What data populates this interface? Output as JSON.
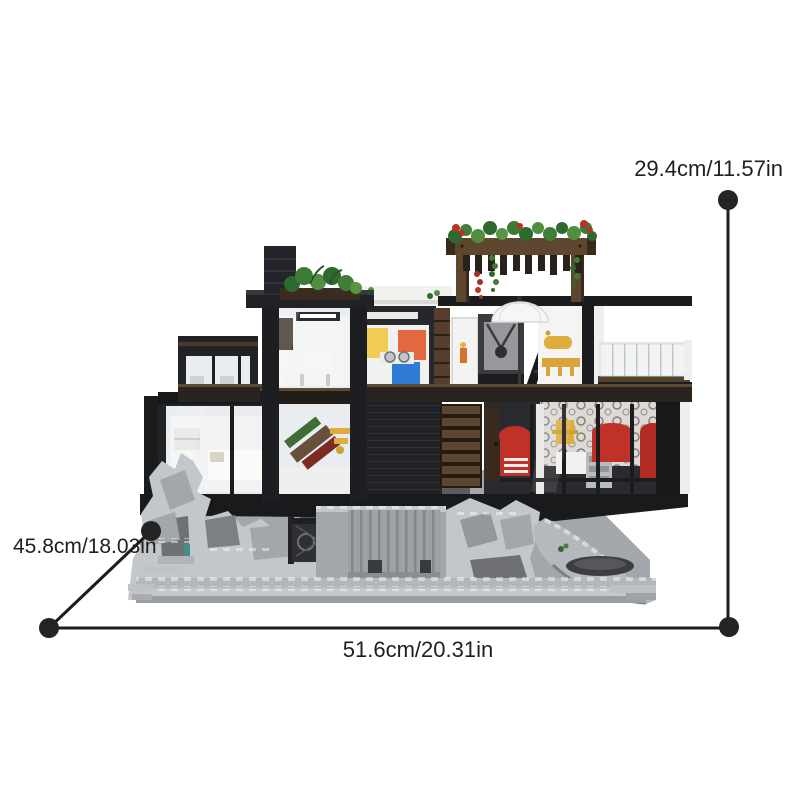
{
  "page": {
    "background_color": "#ffffff"
  },
  "subject": {
    "caption": "Brick-built modern glass cliff house model with rooftop pergola garden on a gray rocky base"
  },
  "dimension_labels": {
    "height": "29.4cm/11.57in",
    "depth": "45.8cm/18.03in",
    "width": "51.6cm/20.31in"
  },
  "annotation_style": {
    "line_color": "#1c1c1c",
    "dot_color": "#242424",
    "text_color": "#1f1f1f"
  },
  "model_colors": {
    "frame_black": "#212225",
    "glass_tint": "#e9edf0",
    "interior_white": "#f4f4f3",
    "rock_light": "#c3c6ca",
    "rock_mid": "#a3a6ab",
    "rock_dark": "#6e7175",
    "wood_brown": "#5f462f",
    "slat_brown": "#5d4632",
    "foliage_green": "#2e6a30",
    "flower_red": "#b23527",
    "cabinet_yellow": "#f0cc55",
    "cabinet_orange": "#e4683f",
    "cabinet_blue": "#2e7cd6",
    "sofa_red": "#c03128",
    "gold_yellow": "#e0ac3c",
    "page_bg": "#ffffff"
  }
}
